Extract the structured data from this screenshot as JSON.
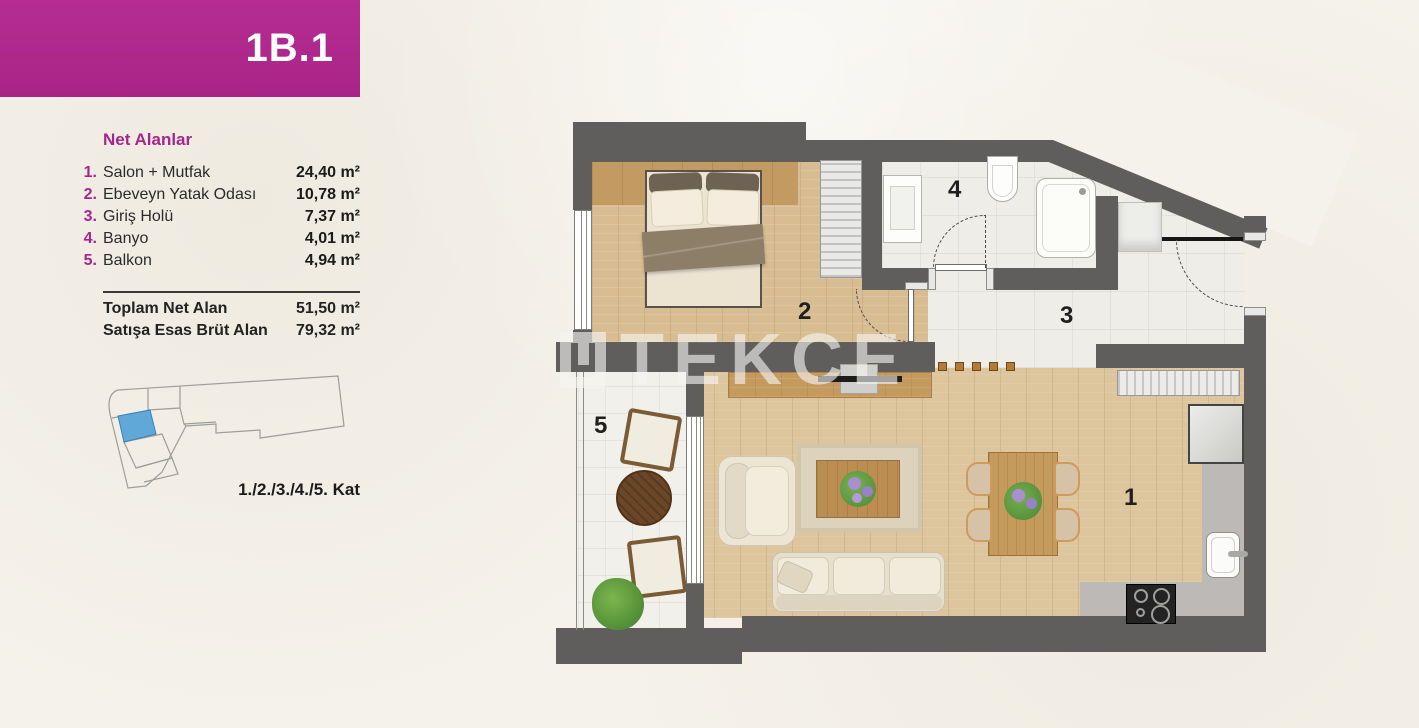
{
  "banner": {
    "unit_code": "1B.1",
    "color": "#b12a8c"
  },
  "areas": {
    "title": "Net Alanlar",
    "rows": [
      {
        "no": "1.",
        "label": "Salon + Mutfak",
        "value": "24,40 m²"
      },
      {
        "no": "2.",
        "label": "Ebeveyn Yatak Odası",
        "value": "10,78 m²"
      },
      {
        "no": "3.",
        "label": "Giriş Holü",
        "value": "7,37 m²"
      },
      {
        "no": "4.",
        "label": "Banyo",
        "value": "4,01 m²"
      },
      {
        "no": "5.",
        "label": "Balkon",
        "value": "4,94 m²"
      }
    ],
    "totals": [
      {
        "label": "Toplam Net Alan",
        "value": "51,50 m²"
      },
      {
        "label": "Satışa Esas Brüt Alan",
        "value": "79,32 m²"
      }
    ]
  },
  "location": {
    "floors_label": "1./2./3./4./5. Kat",
    "highlight_color": "#5fa8d8",
    "highlight_stroke": "#3a82b8"
  },
  "plan": {
    "room_labels": {
      "salon": "1",
      "bedroom": "2",
      "hall": "3",
      "bath": "4",
      "balcony": "5"
    },
    "wall_color": "#5f5e5c",
    "wood_color": "#ddc59d",
    "tile_color": "#efede7",
    "counter_color": "#bdb9b6"
  },
  "watermark": {
    "text": "TEKCE"
  }
}
